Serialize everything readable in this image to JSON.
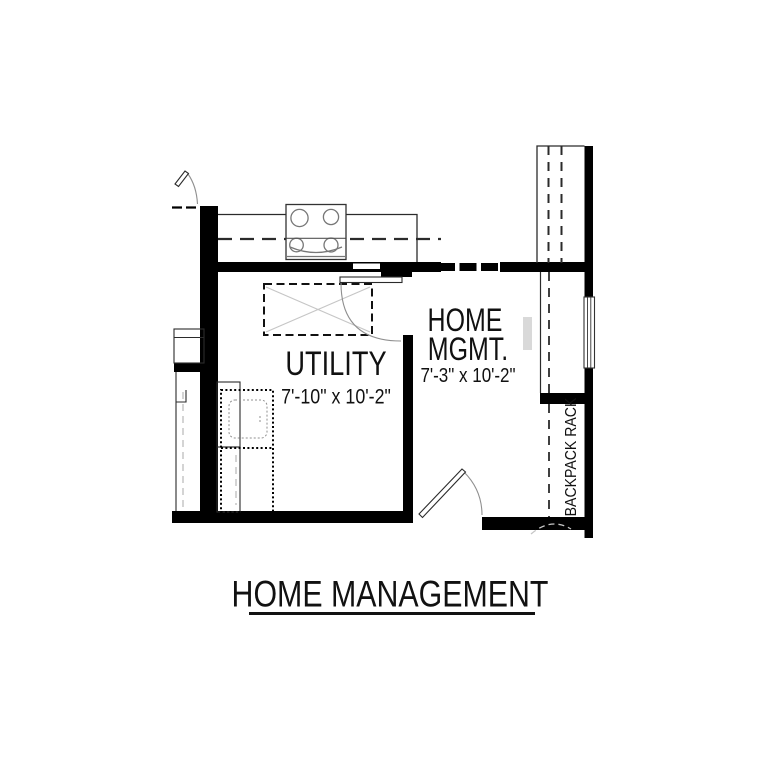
{
  "figure": {
    "title": "HOME MANAGEMENT"
  },
  "rooms": {
    "utility": {
      "name": "UTILITY",
      "dims": "7'-10\" x 10'-2\""
    },
    "home_mgmt": {
      "name_line1": "HOME",
      "name_line2": "MGMT.",
      "dims": "7'-3\" x 10'-2\""
    }
  },
  "fixtures": {
    "backpack_rack": "BACKPACK RACK"
  },
  "colors": {
    "wall": "#000000",
    "line": "#2b2b2b",
    "door_swing": "#8f8f8f",
    "light_detail": "#c6c6c6",
    "background": "#ffffff"
  }
}
